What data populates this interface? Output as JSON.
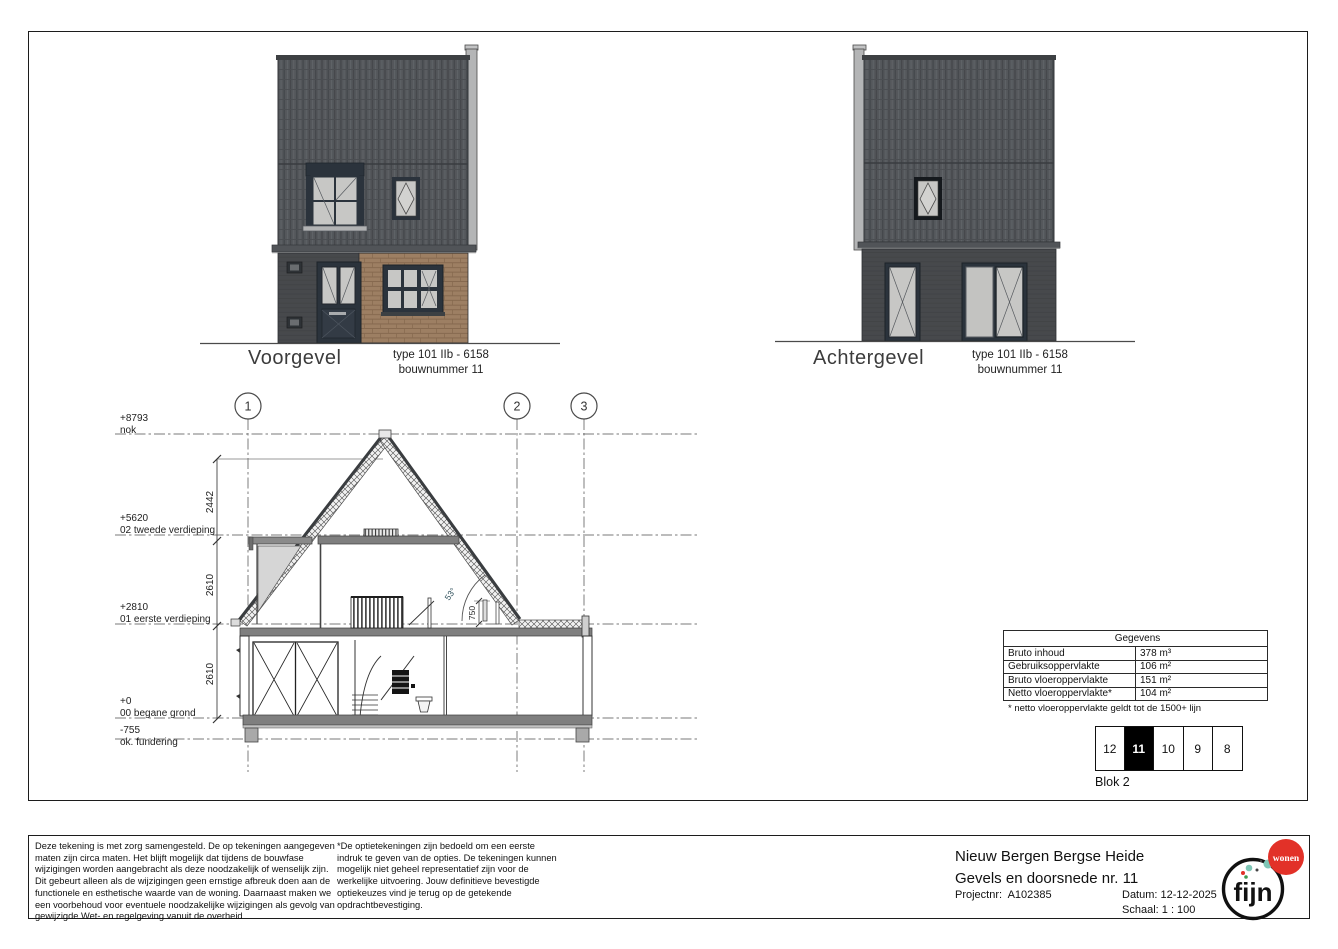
{
  "facades": {
    "front": {
      "label": "Voorgevel",
      "type": "type 101 IIb - 6158",
      "bouwnummer": "bouwnummer 11"
    },
    "rear": {
      "label": "Achtergevel",
      "type": "type 101 IIb - 6158",
      "bouwnummer": "bouwnummer 11"
    }
  },
  "section": {
    "grids": [
      "1",
      "2",
      "3"
    ],
    "levels": [
      {
        "elevation": "+8793",
        "name": "nok"
      },
      {
        "elevation": "+5620",
        "name": "02 tweede verdieping"
      },
      {
        "elevation": "+2810",
        "name": "01 eerste verdieping"
      },
      {
        "elevation": "+0",
        "name": "00 begane grond"
      },
      {
        "elevation": "-755",
        "name": "ok. fundering"
      }
    ],
    "dimensions": [
      "2442",
      "2610",
      "2610"
    ],
    "roof_angle": "53°",
    "parapet_dim": "750"
  },
  "gegevens": {
    "title": "Gegevens",
    "rows": [
      {
        "label": "Bruto inhoud",
        "value": "378 m³"
      },
      {
        "label": "Gebruiksoppervlakte",
        "value": "106 m²"
      },
      {
        "label": "Bruto vloeroppervlakte",
        "value": "151 m²"
      },
      {
        "label": "Netto vloeroppervlakte*",
        "value": "104 m²"
      }
    ],
    "footnote": "* netto vloeroppervlakte geldt tot de 1500+ lijn"
  },
  "blok": {
    "cells": [
      "12",
      "11",
      "10",
      "9",
      "8"
    ],
    "active": "11",
    "label": "Blok 2"
  },
  "footer": {
    "disclaimer_left": "Deze tekening is met zorg samengesteld. De op tekeningen aangegeven maten zijn circa maten. Het blijft mogelijk dat tijdens de bouwfase wijzigingen worden aangebracht als deze noodzakelijk of wenselijk zijn. Dit gebeurt alleen als de wijzigingen geen ernstige afbreuk doen aan de functionele en esthetische waarde van de woning. Daarnaast maken we een voorbehoud voor eventuele noodzakelijke wijzigingen als gevolg van gewijzigde Wet- en regelgeving vanuit de overheid",
    "disclaimer_right": "*De optietekeningen zijn bedoeld om een eerste indruk te geven van de opties. De tekeningen kunnen mogelijk niet geheel representatief zijn voor de werkelijke uitvoering. Jouw definitieve bevestigde optiekeuzes vind je terug op de getekende opdrachtbevestiging.",
    "project_name": "Nieuw Bergen Bergse Heide",
    "drawing_name": "Gevels en doorsnede nr. 11",
    "projectnr_label": "Projectnr:",
    "projectnr_value": "A102385",
    "datum_label": "Datum:",
    "datum_value": "12-12-2025",
    "schaal_label": "Schaal:",
    "schaal_value": "1 : 100",
    "logo_text": "fijn",
    "logo_badge": "wonen"
  },
  "colors": {
    "roof": "#54575b",
    "dark_wall": "#47494c",
    "brick": "#9d7f63",
    "frame_dark": "#2b333c",
    "glass": "#c7c7c5",
    "slab": "#7f7f7f",
    "accent_red": "#e23128",
    "logo_teal": "#7fc6b6"
  }
}
